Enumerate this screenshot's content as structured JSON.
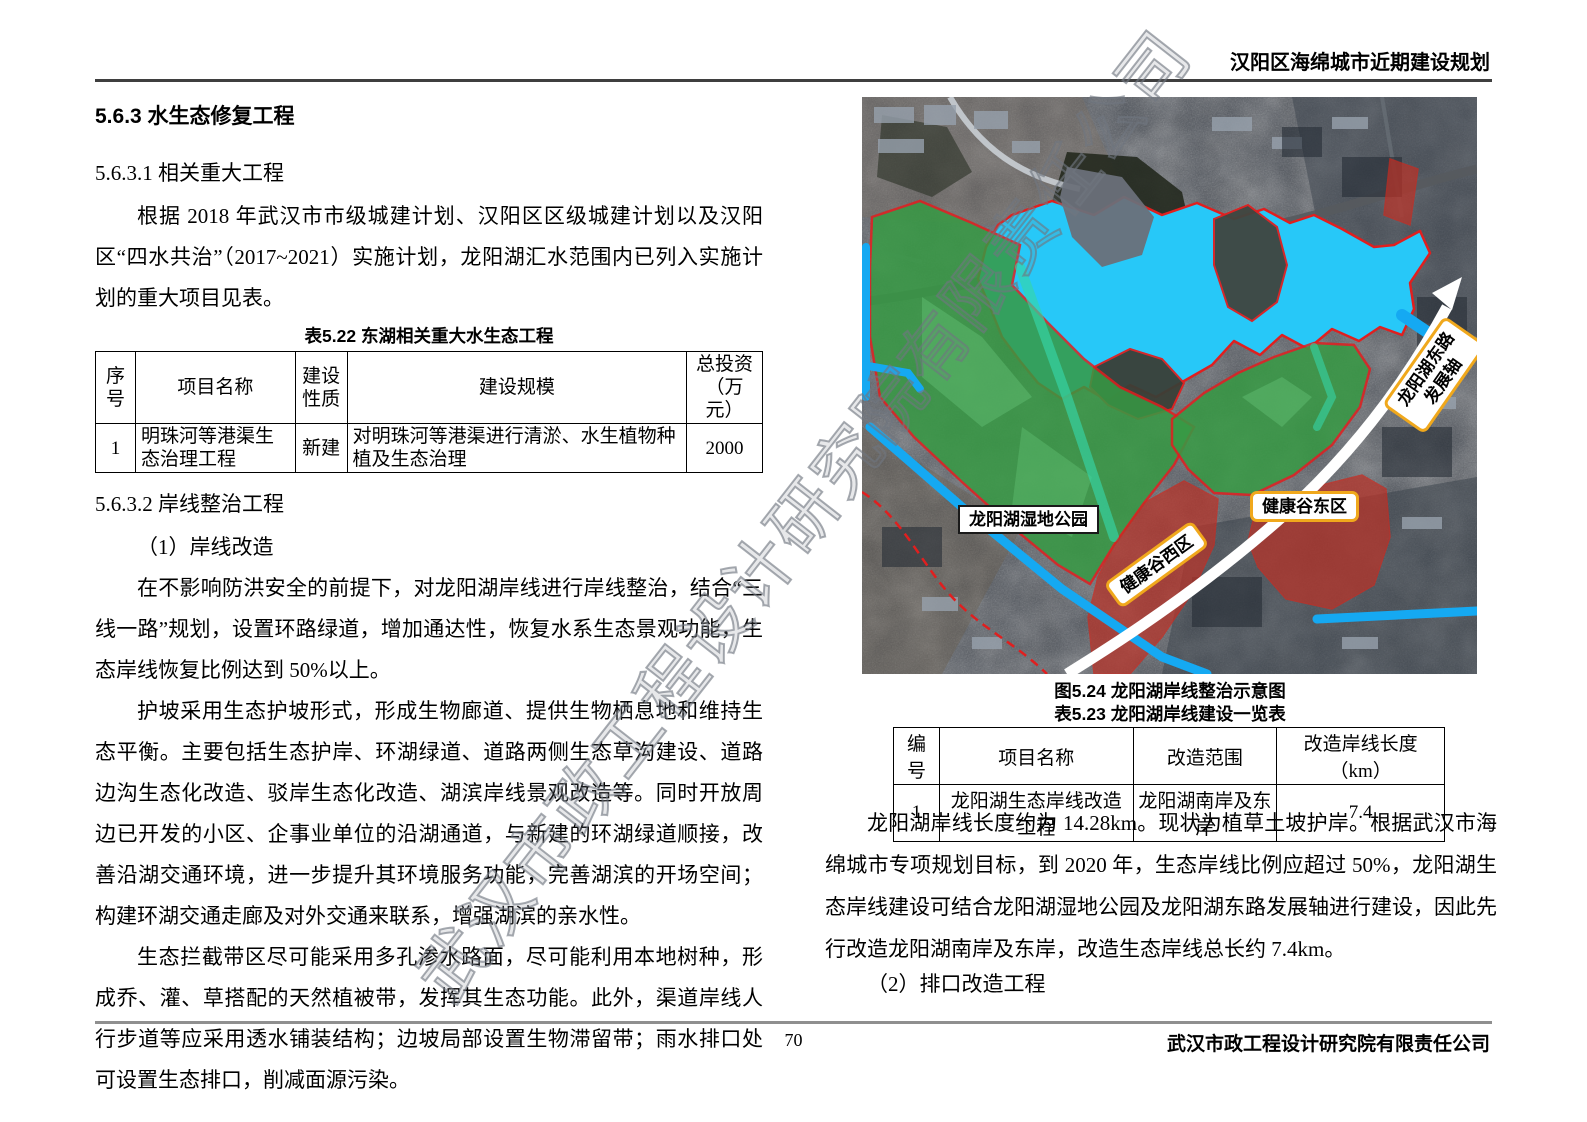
{
  "header": {
    "title": "汉阳区海绵城市近期建设规划"
  },
  "watermark": "武汉市政工程设计研究院有限责任公司",
  "left": {
    "h1": "5.6.3 水生态修复工程",
    "h2": "5.6.3.1 相关重大工程",
    "p1": "根据 2018 年武汉市市级城建计划、汉阳区区级城建计划以及汉阳区“四水共治”（2017~2021）实施计划，龙阳湖汇水范围内已列入实施计划的重大项目见表。",
    "table522": {
      "caption": "表5.22 东湖相关重大水生态工程",
      "headers": [
        "序号",
        "项目名称",
        "建设性质",
        "建设规模",
        "总投资（万元）"
      ],
      "row": [
        "1",
        "明珠河等港渠生态治理工程",
        "新建",
        "对明珠河等港渠进行清淤、水生植物种植及生态治理",
        "2000"
      ]
    },
    "h3": "5.6.3.2 岸线整治工程",
    "sub1": "（1）岸线改造",
    "p2": "在不影响防洪安全的前提下，对龙阳湖岸线进行岸线整治，结合“三线一路”规划，设置环路绿道，增加通达性，恢复水系生态景观功能，生态岸线恢复比例达到 50%以上。",
    "p3": "护坡采用生态护坡形式，形成生物廊道、提供生物栖息地和维持生态平衡。主要包括生态护岸、环湖绿道、道路两侧生态草沟建设、道路边沟生态化改造、驳岸生态化改造、湖滨岸线景观改造等。同时开放周边已开发的小区、企事业单位的沿湖通道，与新建的环湖绿道顺接，改善沿湖交通环境，进一步提升其环境服务功能，完善湖滨的开场空间；构建环湖交通走廊及对外交通来联系，增强湖滨的亲水性。",
    "p4": "生态拦截带区尽可能采用多孔渗水路面，尽可能利用本地树种，形成乔、灌、草搭配的天然植被带，发挥其生态功能。此外，渠道岸线人行步道等应采用透水铺装结构；边坡局部设置生物滞留带；雨水排口处可设置生态排口，削减面源污染。"
  },
  "map": {
    "labels": {
      "wetland_park": "龙阳湖湿地公园",
      "health_valley_west": "健康谷西区",
      "health_valley_east": "健康谷东区",
      "axis_line1": "龙阳湖东路",
      "axis_line2": "发展轴"
    },
    "colors": {
      "lake": "#27c8f8",
      "park_green": "#379a44",
      "zone_red": "#b93227",
      "waterline_blue": "#15a9f2",
      "label_border_orange": "#f0a81c",
      "boundary_red": "#e01f1f"
    }
  },
  "right": {
    "figure_caption": "图5.24 龙阳湖岸线整治示意图",
    "table523": {
      "caption": "表5.23 龙阳湖岸线建设一览表",
      "headers": [
        "编号",
        "项目名称",
        "改造范围",
        "改造岸线长度（km）"
      ],
      "row": [
        "1",
        "龙阳湖生态岸线改造工程",
        "龙阳湖南岸及东岸",
        "7.4"
      ]
    },
    "p5": "龙阳湖岸线长度约为 14.28km。现状为植草土坡护岸。根据武汉市海绵城市专项规划目标，到 2020 年，生态岸线比例应超过 50%，龙阳湖生态岸线建设可结合龙阳湖湿地公园及龙阳湖东路发展轴进行建设，因此先行改造龙阳湖南岸及东岸，改造生态岸线总长约 7.4km。",
    "sub2": "（2）排口改造工程"
  },
  "footer": {
    "page_number": "70",
    "company": "武汉市政工程设计研究院有限责任公司"
  }
}
